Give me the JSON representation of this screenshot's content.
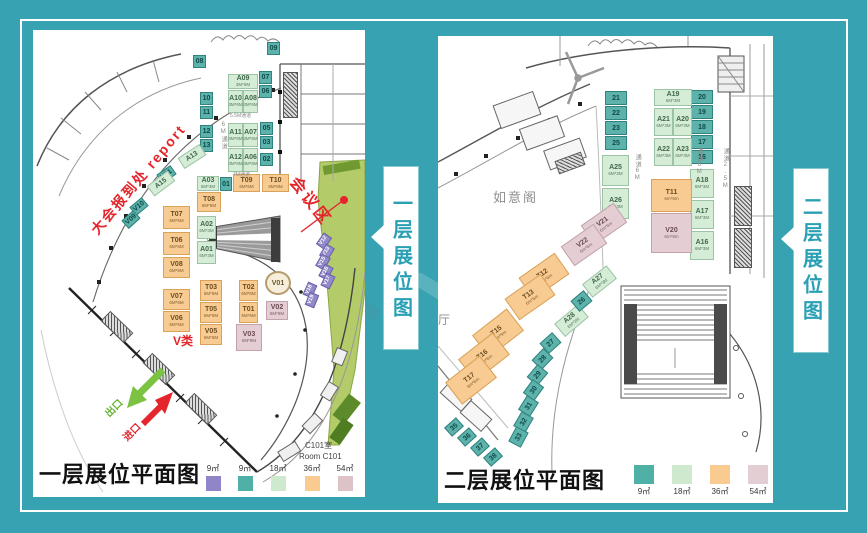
{
  "background": {
    "color": "#37a2b1"
  },
  "banners": [
    {
      "text": "一层展位图"
    },
    {
      "text": "二层展位图"
    }
  ],
  "panels": [
    {
      "title": "一层展位平面图",
      "legend": [
        {
          "label": "9㎡",
          "color": "#8f85c8"
        },
        {
          "label": "9㎡",
          "color": "#4fb0a5"
        },
        {
          "label": "18㎡",
          "color": "#cfe9cf"
        },
        {
          "label": "36㎡",
          "color": "#f9cb90"
        },
        {
          "label": "54㎡",
          "color": "#ddc3c8"
        }
      ],
      "annotations": {
        "report": "大会报到处  report",
        "meeting_zone": "会议区",
        "v_class": "V类",
        "exit": "出口",
        "entrance": "进口",
        "room_c101_cn": "C101室",
        "room_c101_en": "Room C101",
        "aisle_55": "5.5M通道",
        "aisle_7": "7M通道",
        "aisle_6": "6M通道"
      },
      "booths": [
        {
          "id": "09",
          "t": "t9",
          "x": 234,
          "y": 12,
          "w": 13,
          "h": 13
        },
        {
          "id": "08",
          "t": "t9",
          "x": 160,
          "y": 25,
          "w": 13,
          "h": 13
        },
        {
          "id": "07",
          "t": "t9",
          "x": 226,
          "y": 41,
          "w": 13,
          "h": 13
        },
        {
          "id": "06",
          "t": "t9",
          "x": 226,
          "y": 55,
          "w": 13,
          "h": 13
        },
        {
          "id": "10",
          "t": "t9",
          "x": 167,
          "y": 62,
          "w": 13,
          "h": 13
        },
        {
          "id": "11",
          "t": "t9",
          "x": 167,
          "y": 76,
          "w": 13,
          "h": 13
        },
        {
          "id": "12",
          "t": "t9",
          "x": 167,
          "y": 95,
          "w": 13,
          "h": 13
        },
        {
          "id": "13",
          "t": "t9",
          "x": 167,
          "y": 109,
          "w": 13,
          "h": 13
        },
        {
          "id": "05",
          "t": "t9",
          "x": 227,
          "y": 92,
          "w": 13,
          "h": 13
        },
        {
          "id": "03",
          "t": "t9",
          "x": 227,
          "y": 106,
          "w": 13,
          "h": 13
        },
        {
          "id": "02",
          "t": "t9",
          "x": 227,
          "y": 123,
          "w": 13,
          "h": 13
        },
        {
          "id": "01",
          "t": "t9",
          "x": 187,
          "y": 147,
          "w": 12,
          "h": 14
        },
        {
          "id": "A09",
          "t": "g18",
          "x": 195,
          "y": 44,
          "w": 30,
          "h": 15,
          "sub": "3M*6M"
        },
        {
          "id": "A10",
          "t": "g18",
          "x": 195,
          "y": 60,
          "w": 15,
          "h": 23,
          "sub": "3M*6M"
        },
        {
          "id": "A08",
          "t": "g18",
          "x": 210,
          "y": 60,
          "w": 15,
          "h": 23,
          "sub": "3M*6M"
        },
        {
          "id": "A11",
          "t": "g18",
          "x": 195,
          "y": 93,
          "w": 15,
          "h": 24,
          "sub": "3M*6M"
        },
        {
          "id": "A07",
          "t": "g18",
          "x": 210,
          "y": 93,
          "w": 15,
          "h": 24,
          "sub": "3M*6M"
        },
        {
          "id": "A12",
          "t": "g18",
          "x": 195,
          "y": 118,
          "w": 15,
          "h": 24,
          "sub": "3M*6M"
        },
        {
          "id": "A06",
          "t": "g18",
          "x": 210,
          "y": 118,
          "w": 15,
          "h": 24,
          "sub": "3M*6M"
        },
        {
          "id": "A13",
          "t": "g18",
          "x": 146,
          "y": 120,
          "w": 26,
          "h": 13,
          "r": -33
        },
        {
          "id": "V11",
          "t": "t9",
          "x": 125,
          "y": 139,
          "w": 17,
          "h": 11,
          "r": -35
        },
        {
          "id": "A15",
          "t": "g18",
          "x": 115,
          "y": 147,
          "w": 26,
          "h": 13,
          "r": -37
        },
        {
          "id": "V10",
          "t": "t9",
          "x": 98,
          "y": 171,
          "w": 16,
          "h": 11,
          "r": -40
        },
        {
          "id": "V09",
          "t": "t9",
          "x": 90,
          "y": 184,
          "w": 16,
          "h": 11,
          "r": -42
        },
        {
          "id": "A03",
          "t": "g18",
          "x": 164,
          "y": 146,
          "w": 22,
          "h": 15,
          "sub": "6M*3M"
        },
        {
          "id": "T09",
          "t": "o36",
          "x": 200,
          "y": 144,
          "w": 27,
          "h": 18,
          "sub": "6M*6M"
        },
        {
          "id": "T10",
          "t": "o36",
          "x": 229,
          "y": 144,
          "w": 27,
          "h": 18,
          "sub": "6M*6M"
        },
        {
          "id": "T08",
          "t": "o36",
          "x": 164,
          "y": 162,
          "w": 24,
          "h": 20,
          "sub": "6M*6M"
        },
        {
          "id": "T07",
          "t": "o36",
          "x": 130,
          "y": 176,
          "w": 27,
          "h": 23,
          "sub": "6M*6M"
        },
        {
          "id": "A02",
          "t": "g18",
          "x": 164,
          "y": 186,
          "w": 19,
          "h": 23,
          "sub": "6M*3M"
        },
        {
          "id": "T06",
          "t": "o36",
          "x": 130,
          "y": 202,
          "w": 27,
          "h": 23,
          "sub": "6M*6M"
        },
        {
          "id": "A01",
          "t": "g18",
          "x": 164,
          "y": 211,
          "w": 19,
          "h": 23,
          "sub": "6M*3M"
        },
        {
          "id": "V08",
          "t": "o36",
          "x": 130,
          "y": 227,
          "w": 27,
          "h": 21,
          "sub": "6M*6M"
        },
        {
          "id": "V07",
          "t": "o36",
          "x": 130,
          "y": 259,
          "w": 27,
          "h": 21,
          "sub": "6M*6M"
        },
        {
          "id": "V06",
          "t": "o36",
          "x": 130,
          "y": 281,
          "w": 27,
          "h": 21,
          "sub": "6M*6M"
        },
        {
          "id": "T03",
          "t": "o36",
          "x": 167,
          "y": 250,
          "w": 22,
          "h": 21,
          "sub": "6M*6M"
        },
        {
          "id": "T05",
          "t": "o36",
          "x": 167,
          "y": 272,
          "w": 22,
          "h": 21,
          "sub": "6M*6M"
        },
        {
          "id": "V05",
          "t": "o36",
          "x": 167,
          "y": 294,
          "w": 22,
          "h": 21,
          "sub": "6M*6M"
        },
        {
          "id": "T02",
          "t": "o36",
          "x": 206,
          "y": 250,
          "w": 19,
          "h": 21,
          "sub": "6M*6M"
        },
        {
          "id": "T01",
          "t": "o36",
          "x": 206,
          "y": 272,
          "w": 19,
          "h": 21,
          "sub": "6M*6M"
        },
        {
          "id": "V03",
          "t": "k54",
          "x": 203,
          "y": 294,
          "w": 26,
          "h": 27,
          "sub": "6M*9M"
        },
        {
          "id": "V02",
          "t": "k54",
          "x": 233,
          "y": 271,
          "w": 22,
          "h": 19,
          "sub": "6M*9M"
        },
        {
          "id": "V01",
          "t": "circle",
          "x": 232,
          "y": 241,
          "w": 26,
          "h": 24
        },
        {
          "id": "V12",
          "t": "p9",
          "x": 284,
          "y": 206,
          "w": 14,
          "h": 10,
          "r": -55
        },
        {
          "id": "V13",
          "t": "p9",
          "x": 287,
          "y": 217,
          "w": 14,
          "h": 10,
          "r": -58
        },
        {
          "id": "V15",
          "t": "p9",
          "x": 283,
          "y": 227,
          "w": 14,
          "h": 10,
          "r": -60
        },
        {
          "id": "V16",
          "t": "p9",
          "x": 286,
          "y": 237,
          "w": 14,
          "h": 10,
          "r": -62
        },
        {
          "id": "V17",
          "t": "p9",
          "x": 288,
          "y": 246,
          "w": 14,
          "h": 10,
          "r": -64
        },
        {
          "id": "V18",
          "t": "p9",
          "x": 270,
          "y": 255,
          "w": 14,
          "h": 10,
          "r": -66
        },
        {
          "id": "V19",
          "t": "p9",
          "x": 272,
          "y": 265,
          "w": 14,
          "h": 10,
          "r": -68
        }
      ]
    },
    {
      "title": "二层展位平面图",
      "legend": [
        {
          "label": "9㎡",
          "color": "#4fb0a5"
        },
        {
          "label": "18㎡",
          "color": "#cfe9cf"
        },
        {
          "label": "36㎡",
          "color": "#f9cb90"
        },
        {
          "label": "54㎡",
          "color": "#e3ced3"
        }
      ],
      "annotations": {
        "ruyi_pavilion": "如意阁",
        "hall": "厅",
        "aisle_left": "通道6M",
        "aisle_center": "通道6M",
        "aisle_right": "通道2.5M"
      },
      "booths": [
        {
          "id": "21",
          "t": "t9",
          "x": 167,
          "y": 55,
          "w": 22,
          "h": 14
        },
        {
          "id": "22",
          "t": "t9",
          "x": 167,
          "y": 70,
          "w": 22,
          "h": 14
        },
        {
          "id": "23",
          "t": "t9",
          "x": 167,
          "y": 85,
          "w": 22,
          "h": 14
        },
        {
          "id": "25",
          "t": "t9",
          "x": 167,
          "y": 100,
          "w": 22,
          "h": 14
        },
        {
          "id": "20",
          "t": "t9",
          "x": 253,
          "y": 54,
          "w": 22,
          "h": 14
        },
        {
          "id": "19",
          "t": "t9",
          "x": 253,
          "y": 69,
          "w": 22,
          "h": 14
        },
        {
          "id": "18",
          "t": "t9",
          "x": 253,
          "y": 84,
          "w": 22,
          "h": 14
        },
        {
          "id": "17",
          "t": "t9",
          "x": 253,
          "y": 99,
          "w": 22,
          "h": 14
        },
        {
          "id": "16",
          "t": "t9",
          "x": 253,
          "y": 114,
          "w": 22,
          "h": 14
        },
        {
          "id": "A25",
          "t": "g18",
          "x": 164,
          "y": 119,
          "w": 27,
          "h": 31,
          "sub": "6M*3M"
        },
        {
          "id": "A26",
          "t": "g18",
          "x": 164,
          "y": 152,
          "w": 27,
          "h": 31,
          "sub": "6M*3M"
        },
        {
          "id": "A19",
          "t": "g18",
          "x": 216,
          "y": 53,
          "w": 38,
          "h": 17,
          "sub": "6M*3M"
        },
        {
          "id": "A21",
          "t": "g18",
          "x": 216,
          "y": 72,
          "w": 19,
          "h": 28,
          "sub": "6M*3M"
        },
        {
          "id": "A20",
          "t": "g18",
          "x": 235,
          "y": 72,
          "w": 19,
          "h": 28,
          "sub": "6M*3M"
        },
        {
          "id": "A22",
          "t": "g18",
          "x": 216,
          "y": 102,
          "w": 19,
          "h": 28,
          "sub": "6M*3M"
        },
        {
          "id": "A23",
          "t": "g18",
          "x": 235,
          "y": 102,
          "w": 19,
          "h": 28,
          "sub": "6M*3M"
        },
        {
          "id": "A18",
          "t": "g18",
          "x": 252,
          "y": 133,
          "w": 24,
          "h": 29,
          "sub": "6M*3M"
        },
        {
          "id": "A17",
          "t": "g18",
          "x": 252,
          "y": 164,
          "w": 24,
          "h": 29,
          "sub": "6M*3M"
        },
        {
          "id": "A16",
          "t": "g18",
          "x": 252,
          "y": 195,
          "w": 24,
          "h": 29,
          "sub": "6M*3M"
        },
        {
          "id": "T11",
          "t": "o36",
          "x": 213,
          "y": 143,
          "w": 41,
          "h": 33,
          "sub": "6m*6m"
        },
        {
          "id": "V20",
          "t": "k54",
          "x": 213,
          "y": 177,
          "w": 41,
          "h": 40,
          "sub": "6m*9m"
        },
        {
          "id": "V21",
          "t": "k54",
          "x": 146,
          "y": 176,
          "w": 40,
          "h": 24,
          "r": -35,
          "sub": "6m*6m"
        },
        {
          "id": "V22",
          "t": "k54",
          "x": 126,
          "y": 197,
          "w": 40,
          "h": 24,
          "r": -35,
          "sub": "6m*6m"
        },
        {
          "id": "T12",
          "t": "o36",
          "x": 84,
          "y": 227,
          "w": 44,
          "h": 26,
          "r": -35,
          "sub": "6m*6m"
        },
        {
          "id": "T13",
          "t": "o36",
          "x": 70,
          "y": 248,
          "w": 44,
          "h": 26,
          "r": -35,
          "sub": "6m*6m"
        },
        {
          "id": "T15",
          "t": "o36",
          "x": 38,
          "y": 283,
          "w": 44,
          "h": 28,
          "r": -38,
          "sub": "6m*9m"
        },
        {
          "id": "T16",
          "t": "o36",
          "x": 24,
          "y": 307,
          "w": 44,
          "h": 28,
          "r": -38,
          "sub": "6m*6m"
        },
        {
          "id": "T17",
          "t": "o36",
          "x": 11,
          "y": 330,
          "w": 44,
          "h": 28,
          "r": -38,
          "sub": "6m*6m"
        },
        {
          "id": "A27",
          "t": "g18",
          "x": 146,
          "y": 237,
          "w": 31,
          "h": 17,
          "r": -38,
          "sub": "6M*3M"
        },
        {
          "id": "A28",
          "t": "g18",
          "x": 118,
          "y": 276,
          "w": 31,
          "h": 17,
          "r": -40,
          "sub": "6M*3M"
        },
        {
          "id": "26",
          "t": "t9",
          "x": 135,
          "y": 258,
          "w": 17,
          "h": 14,
          "r": -40
        },
        {
          "id": "27",
          "t": "t9",
          "x": 104,
          "y": 300,
          "w": 17,
          "h": 14,
          "r": -42
        },
        {
          "id": "28",
          "t": "t9",
          "x": 96,
          "y": 316,
          "w": 17,
          "h": 14,
          "r": -46
        },
        {
          "id": "29",
          "t": "t9",
          "x": 91,
          "y": 332,
          "w": 17,
          "h": 14,
          "r": -50
        },
        {
          "id": "30",
          "t": "t9",
          "x": 87,
          "y": 347,
          "w": 17,
          "h": 14,
          "r": -54
        },
        {
          "id": "31",
          "t": "t9",
          "x": 82,
          "y": 363,
          "w": 17,
          "h": 14,
          "r": -58
        },
        {
          "id": "32",
          "t": "t9",
          "x": 77,
          "y": 379,
          "w": 17,
          "h": 14,
          "r": -60
        },
        {
          "id": "33",
          "t": "t9",
          "x": 72,
          "y": 394,
          "w": 17,
          "h": 14,
          "r": -62
        },
        {
          "id": "35",
          "t": "t9",
          "x": 8,
          "y": 385,
          "w": 16,
          "h": 12,
          "r": -42
        },
        {
          "id": "36",
          "t": "t9",
          "x": 21,
          "y": 395,
          "w": 16,
          "h": 12,
          "r": -42
        },
        {
          "id": "37",
          "t": "t9",
          "x": 34,
          "y": 405,
          "w": 16,
          "h": 12,
          "r": -42
        },
        {
          "id": "38",
          "t": "t9",
          "x": 47,
          "y": 415,
          "w": 16,
          "h": 12,
          "r": -42
        }
      ]
    }
  ]
}
